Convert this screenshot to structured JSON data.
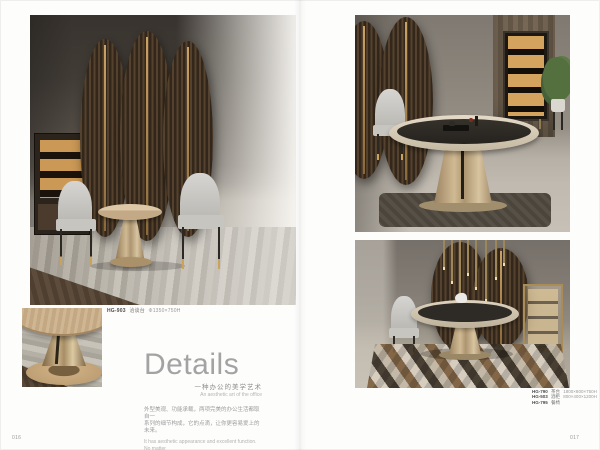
{
  "spread": {
    "left_page": {
      "page_number": "016",
      "main_caption": {
        "code": "HG-903",
        "name": "洽谈台",
        "size": "Φ1350×750H"
      },
      "details": {
        "title": "Details",
        "subtitle_cn": "一种办公的美学艺术",
        "subtitle_en": "An aesthetic art of the office",
        "body_cn": [
          "外型美观、功能承载，两项完美的办公生活都取自一",
          "系列的细节构成，它的点滴，让你更容易爱上的未来。"
        ],
        "body_en": [
          "It has aesthetic appearance and excellent function. No matter",
          "how perfect the office life is, it consists of series of details. Its",
          "extravagance invites you enjoy the end work."
        ]
      }
    },
    "right_page": {
      "page_number": "017",
      "products": [
        {
          "code": "HG-790",
          "name": "茶台",
          "size": "1800×800×750H"
        },
        {
          "code": "HG-503",
          "name": "酒柜",
          "size": "800×400×1200H"
        },
        {
          "code": "HG-795",
          "name": "餐椅",
          "size": ""
        }
      ]
    },
    "colors": {
      "accent_gold": "#b8935f",
      "screen_brown": "#4a3828",
      "text_gray": "#9a9a9a"
    }
  }
}
